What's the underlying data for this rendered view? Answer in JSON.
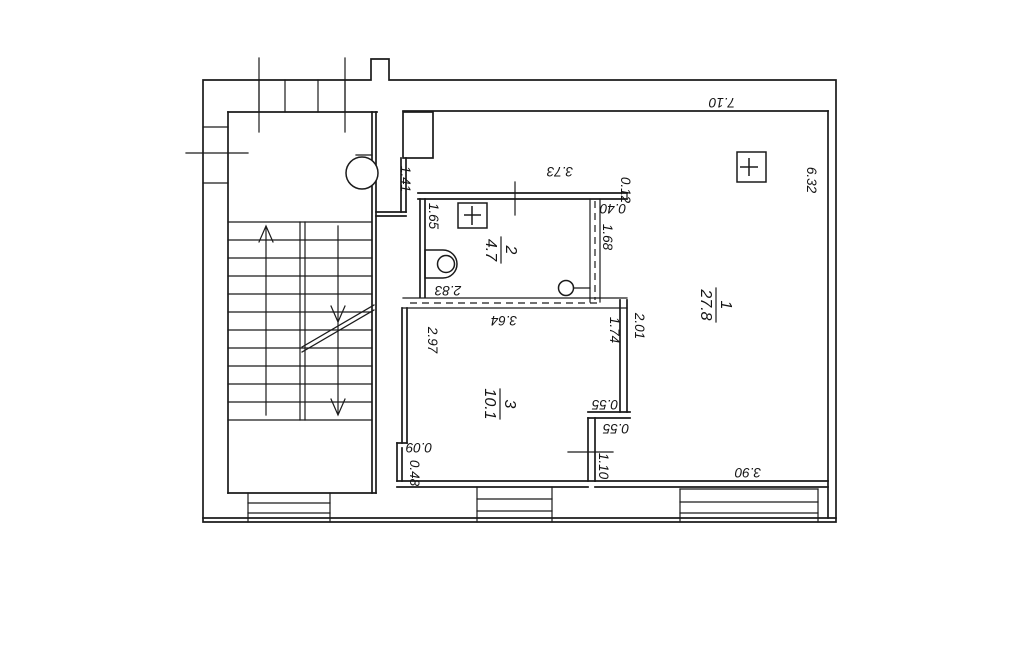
{
  "document": {
    "type": "apartment floor plan scan",
    "background": "#ffffff",
    "line_color": "#1b1b1b"
  },
  "rooms": [
    {
      "number": "1",
      "area": "27.8"
    },
    {
      "number": "2",
      "area": "4.7"
    },
    {
      "number": "3",
      "area": "10.1"
    }
  ],
  "dimensions": {
    "room1_width_top": "7.10",
    "room1_height_right": "6.32",
    "alcove_height": "1.41",
    "room2_width_top": "3.73",
    "wall_offset_top": "0.12",
    "partition_stub": "0.40",
    "partition_height": "1.68",
    "room2_height_left": "1.65",
    "room2_width_bottom": "2.83",
    "room3_width_top": "3.64",
    "room3_height_left": "2.97",
    "divider_inner_height": "1.74",
    "divider_outer_height": "2.01",
    "step_upper": "0.55",
    "step_lower": "0.55",
    "window_wall_height": "1.10",
    "notch_depth": "0.09",
    "notch_height": "0.48",
    "balcony_width": "3.90"
  }
}
